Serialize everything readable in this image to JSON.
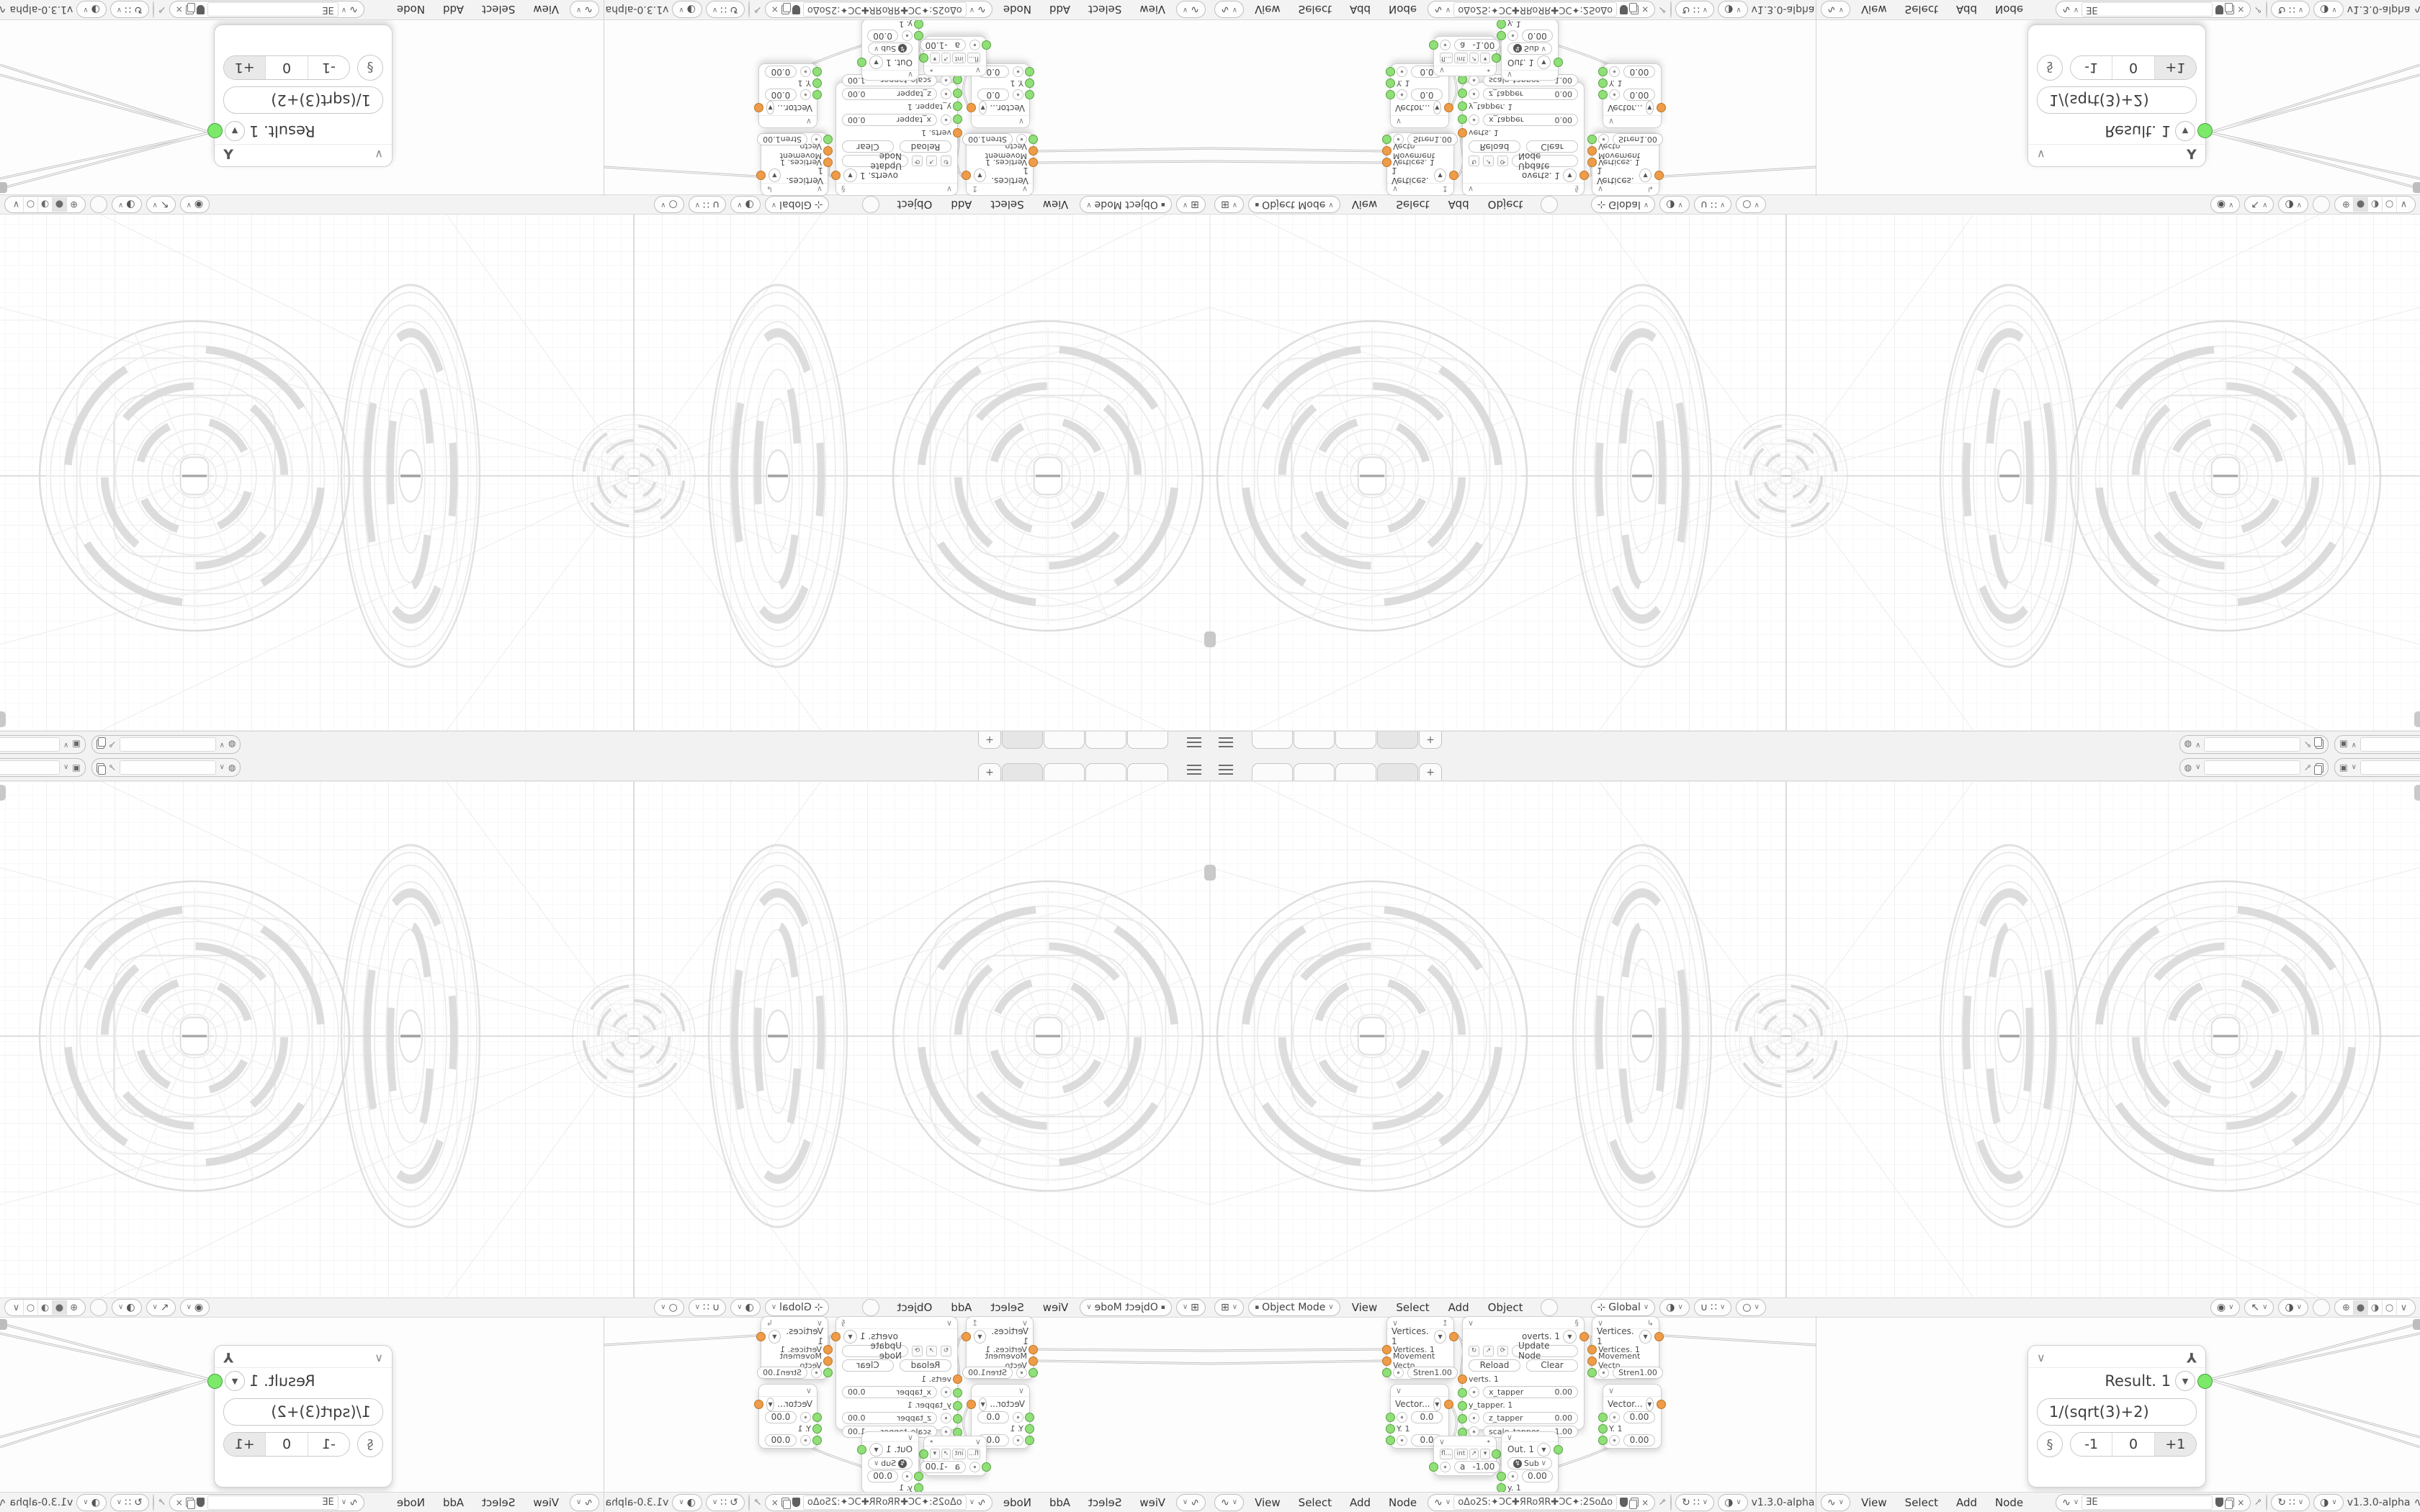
{
  "topbar": {
    "new_tab_label": "+"
  },
  "viewport_header": {
    "mode": "Object Mode",
    "menus": [
      "View",
      "Select",
      "Add",
      "Object"
    ],
    "orientation": "Global"
  },
  "node_editor": {
    "menus": [
      "View",
      "Select",
      "Add",
      "Node"
    ],
    "left_tree_name": "oΔo2S:✦ƆC✚ЯRoЯR✚ƆC✦:2SoΔo",
    "right_tree_name": "ƎE",
    "version": "v1.3.0-alpha",
    "examples_label": "EXAMPLES",
    "processing_label": "Processing",
    "processing_label_clipped": "Proc"
  },
  "nodes": {
    "vertices": {
      "title": "Vertices. 1",
      "input1": "Vertices. 1",
      "input2": "Movement Vecto...",
      "stren_label": "Stren",
      "stren_value": "1.00"
    },
    "overts": {
      "title": "overts. 1",
      "update_label": "Update Node",
      "reload_label": "Reload",
      "clear_label": "Clear",
      "verts_label": "verts. 1",
      "x_tapper_label": "x_tapper",
      "x_tapper_value": "0.00",
      "y_tapper_label": "y_tapper. 1",
      "z_tapper_label": "z_tapper",
      "z_tapper_value": "0.00",
      "scale_tapper_label": "scale_tapper",
      "scale_tapper_value": "1.00"
    },
    "vector_a": {
      "title": "Vector...",
      "v1": "0.0",
      "y_label": "Y. 1",
      "v2": "0.0"
    },
    "vector_b": {
      "title": "Vector...",
      "v1": "0.00",
      "y_label": "Y. 1",
      "v2": "0.00"
    },
    "number": {
      "float_label": "fl...",
      "int_label": "int",
      "a_label": "a",
      "a_value": "-1.00"
    },
    "out": {
      "title": "Out. 1",
      "op": "Sub",
      "value": "0.00",
      "y_label": "y. 1"
    },
    "result": {
      "title": "Result. 1",
      "formula": "1/(sqrt(3)+2)",
      "btn_minus": "-1",
      "btn_zero": "0",
      "btn_plus": "+1"
    }
  }
}
